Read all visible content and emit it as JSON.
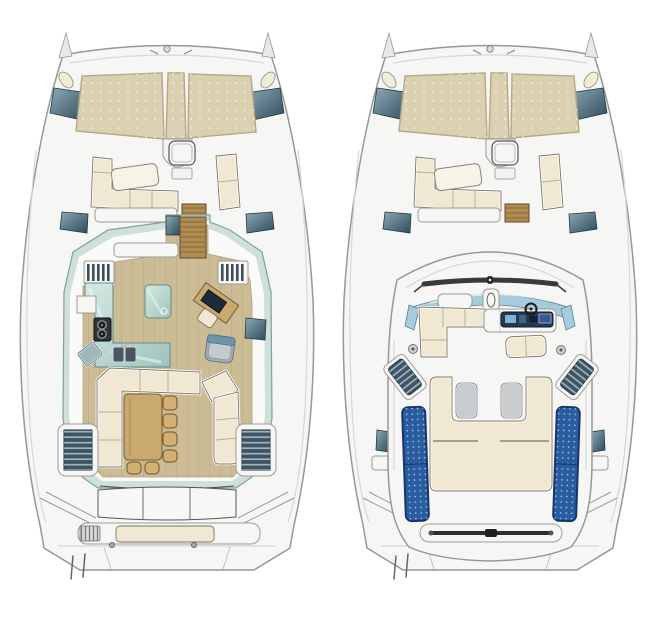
{
  "figure": {
    "title": "Catamaran deck plans — top view, two levels",
    "background": "#ffffff",
    "width_px": 661,
    "height_px": 625
  },
  "palette": {
    "hull_fill": "#f6f6f4",
    "hull_stroke": "#97979a",
    "cushion": "#f1e8d3",
    "cushion_outline": "#79745f",
    "tramp": "#dbd0b2",
    "tramp_border": "#b5a884",
    "wood_floor": "#ccbc96",
    "wood_table": "#c9a96f",
    "teak": "#b18c52",
    "glass": "#cfe0db",
    "window_light": "#8fa9b6",
    "window_dark": "#2d4b5b",
    "step_dark": "#3f5463",
    "solar": "#2a5da0",
    "solar_border": "#16356b",
    "gray_seat": "#9fabb3",
    "rail_dark": "#2f2f2d",
    "counter_light": "#d6e9e4",
    "counter_dark": "#9fc4bd",
    "windshield_blue": "#a6cbdc",
    "console_navy": "#233a52",
    "screen_blue": "#7fb3d8",
    "stove_black": "#30333a"
  },
  "boats": [
    {
      "id": "main-deck",
      "title": "Main deck plan — trampolines, forward cockpit, saloon with galley and dining, aft cockpit",
      "parts": [
        "bow-trampoline",
        "foredeck-lounge",
        "saloon",
        "galley-counter",
        "stove",
        "sink",
        "island-unit",
        "nav-desk",
        "nav-chair",
        "dining-sofa",
        "dining-table",
        "stools",
        "chaise",
        "hull-companionway-steps",
        "aft-cockpit-bench",
        "transom-sunbed",
        "swim-platform"
      ]
    },
    {
      "id": "flybridge",
      "title": "Upper deck plan — coachroof flybridge with helm station, sun pad and solar panels",
      "parts": [
        "bow-trampoline",
        "foredeck-lounge",
        "coachroof",
        "windscreen",
        "flybridge-sofa",
        "helm-console",
        "steering-wheel",
        "helm-bench",
        "sun-pad",
        "headrest-pads",
        "solar-panels",
        "aft-grab-rail",
        "side-steps"
      ]
    }
  ],
  "counts": {
    "trampoline_panels": 3,
    "dining_stools": 6,
    "aft_bench_sections": 3,
    "solar_panels": 2,
    "sun_pad_headrests": 2
  }
}
